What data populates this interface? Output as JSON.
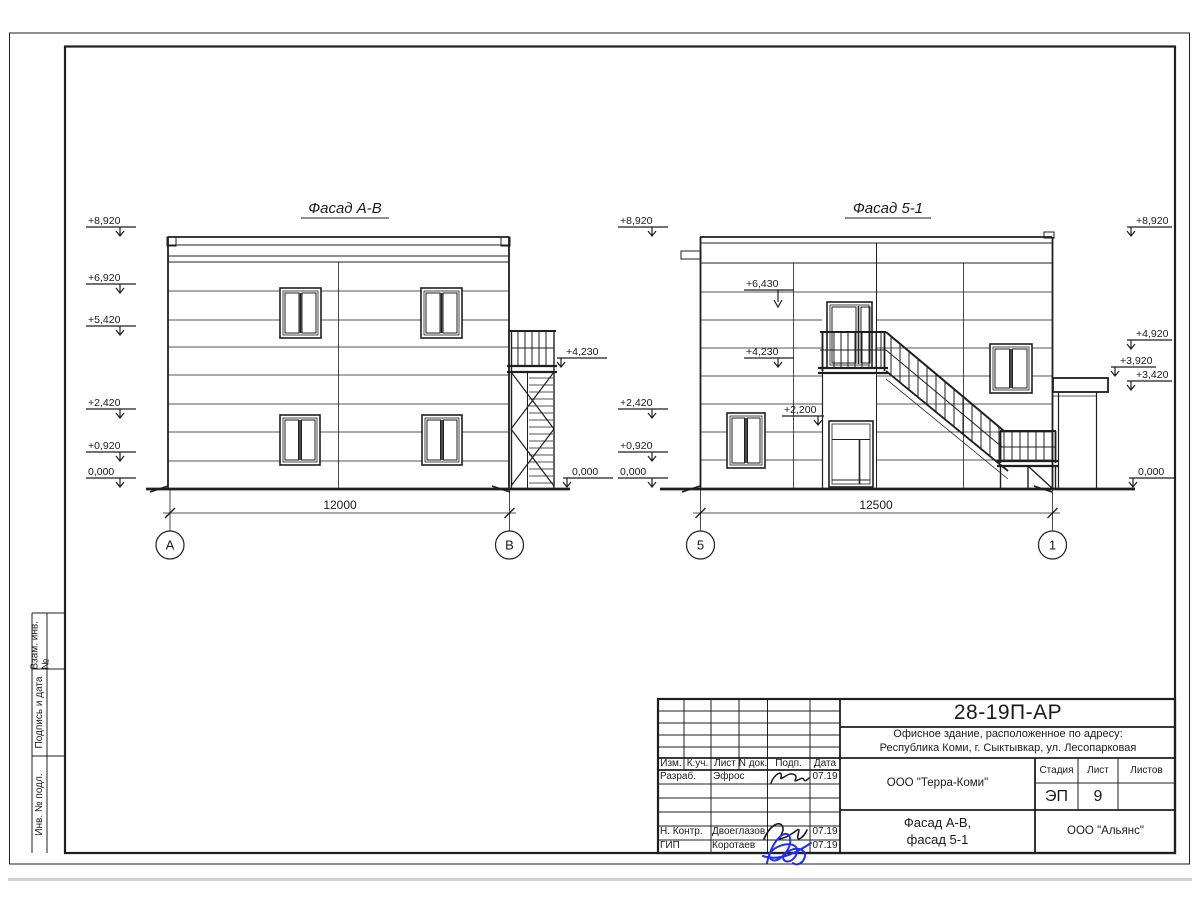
{
  "facade_ab": {
    "title": "Фасад А-В",
    "elevations_left": [
      "+8,920",
      "+6,920",
      "+5,420",
      "+2,420",
      "+0,920",
      "0,000"
    ],
    "elevation_stair": "+4,230",
    "elevation_base_right": "0,000",
    "dimension": "12000",
    "axis_left": "А",
    "axis_right": "В"
  },
  "facade_51": {
    "title": "Фасад 5-1",
    "elevations_left": [
      "+8,920",
      "+2,420",
      "+0,920",
      "0,000"
    ],
    "elevations_inner": [
      "+6,430",
      "+4,230",
      "+2,200"
    ],
    "elevations_right": [
      "+8,920",
      "+4,920",
      "+3,920",
      "+3,420",
      "0,000"
    ],
    "dimension": "12500",
    "axis_left": "5",
    "axis_right": "1"
  },
  "titleblock": {
    "code": "28-19П-АР",
    "address_line1": "Офисное здание, расположенное по адресу:",
    "address_line2": "Республика Коми, г. Сыктывкар, ул. Лесопарковая",
    "col_headers": [
      "Изм.",
      "К.уч.",
      "Лист",
      "N док.",
      "Подп.",
      "Дата"
    ],
    "row_developer_role": "Разраб.",
    "row_developer_name": "Эфрос",
    "row_developer_date": "07.19",
    "row_ncontrol_role": "Н. Контр.",
    "row_ncontrol_name": "Двоеглазов",
    "row_ncontrol_date": "07.19",
    "row_gip_role": "ГИП",
    "row_gip_name": "Коротаев",
    "row_gip_date": "07.19",
    "company": "ООО \"Терра-Коми\"",
    "stage_label": "Стадия",
    "sheet_label": "Лист",
    "sheets_label": "Листов",
    "stage_value": "ЭП",
    "sheet_value": "9",
    "sheets_value": "",
    "title_line1": "Фасад А-В,",
    "title_line2": "фасад 5-1",
    "contractor": "ООО \"Альянс\""
  },
  "margin_labels": [
    "Взам. инв. №",
    "Подпись и дата",
    "Инв. № подл."
  ],
  "colors": {
    "line": "#1f1f1f",
    "signature_blue": "#2130e8"
  }
}
